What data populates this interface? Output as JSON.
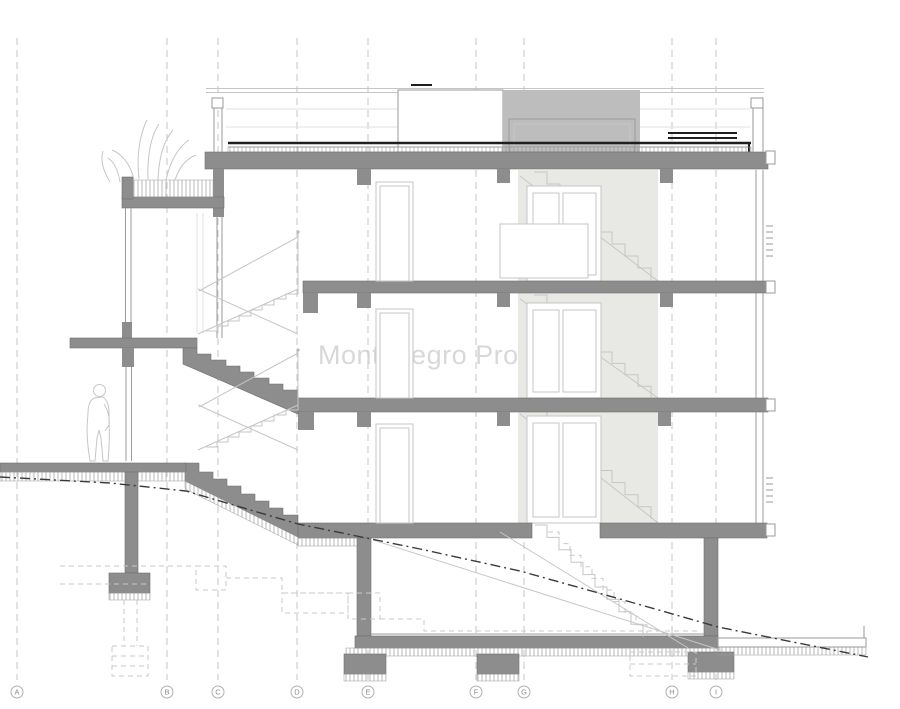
{
  "drawing": {
    "type": "architectural-building-section",
    "watermark": "Montenegro Prospects",
    "title": "Building cross-section with structural grid A–I"
  },
  "grid": {
    "labels": [
      "A",
      "B",
      "C",
      "D",
      "E",
      "F",
      "G",
      "H",
      "I"
    ],
    "x": [
      17,
      167,
      218,
      297,
      368,
      476,
      524,
      672,
      716
    ],
    "bubble_y": 692,
    "line_top": 38,
    "line_bottom": 680
  },
  "colors": {
    "background": "#ffffff",
    "section_fill": "#8d8d8d",
    "section_stroke": "#6e6e6e",
    "roof_box_fill": "#bdbdbd",
    "core_shade": "#e8e8e4",
    "outline_light": "#c6c6c6",
    "outline_mid": "#9a9a9a",
    "faint": "#e2e2e2",
    "dark_line": "#1f1f1f",
    "terrain_line": "#3a3a3a",
    "watermark": "#cccccc",
    "grid_line": "#c6c6c6",
    "grid_label": "#8a8a8a"
  }
}
